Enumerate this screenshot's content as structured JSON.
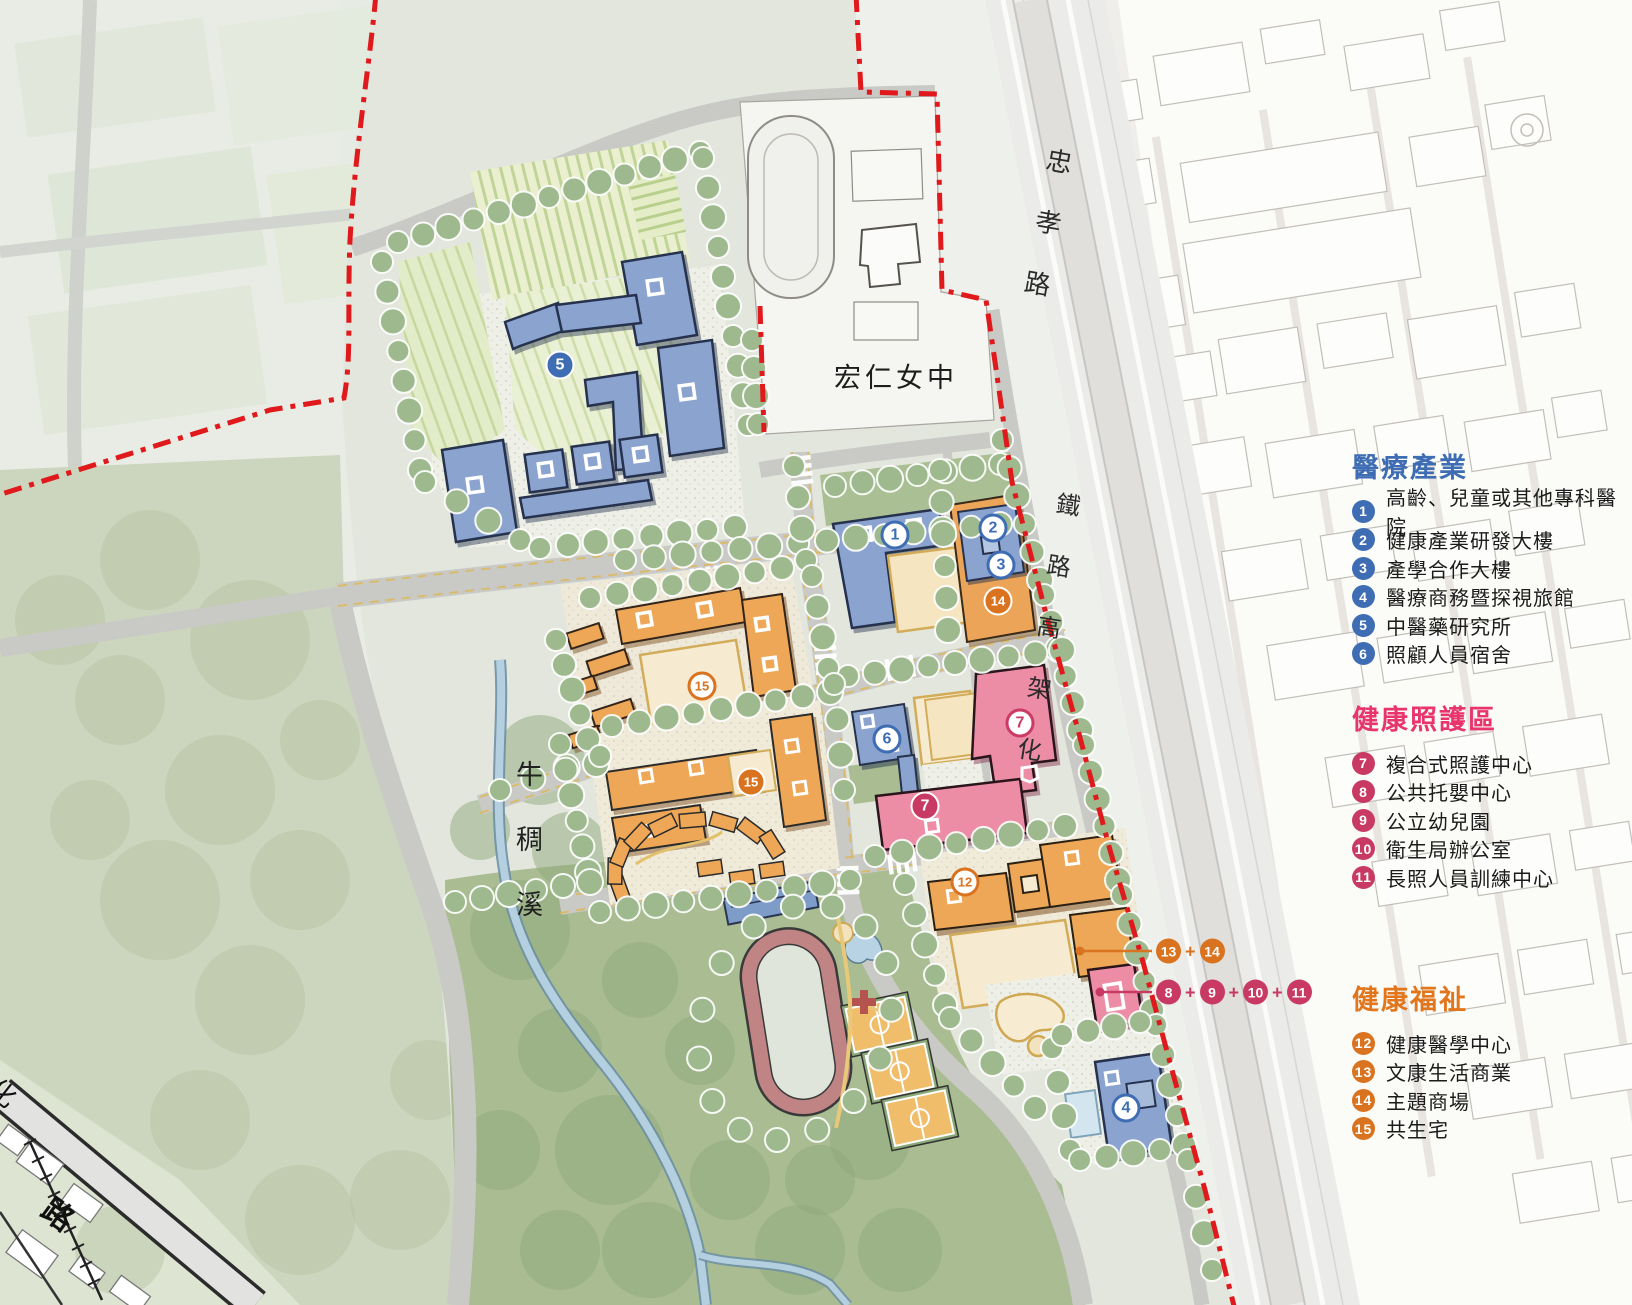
{
  "map_labels": {
    "school": "宏仁女中",
    "road_zhongxiao": "忠孝路",
    "railway_elevated": "鐵路高架化",
    "stream": "牛稠溪",
    "road_char_bottom_left": "路",
    "road_char_left_edge": "化"
  },
  "colors": {
    "medical_blue": "#3e6db4",
    "care_pink_header": "#e8356e",
    "care_pink_badge": "#c83a64",
    "welfare_orange_header": "#e2761c",
    "welfare_orange_badge": "#d9731f",
    "boundary_red": "#e0191c"
  },
  "legend_groups": [
    {
      "id": "medical",
      "title": "醫療產業",
      "header_color": "#3e6db4",
      "badge_color": "#3e6db4",
      "items": [
        {
          "num": "1",
          "label": "高齡、兒童或其他專科醫院"
        },
        {
          "num": "2",
          "label": "健康產業研發大樓"
        },
        {
          "num": "3",
          "label": "產學合作大樓"
        },
        {
          "num": "4",
          "label": "醫療商務暨探視旅館"
        },
        {
          "num": "5",
          "label": "中醫藥研究所"
        },
        {
          "num": "6",
          "label": "照顧人員宿舍"
        }
      ]
    },
    {
      "id": "care",
      "title": "健康照護區",
      "header_color": "#e8356e",
      "badge_color": "#c83a64",
      "items": [
        {
          "num": "7",
          "label": "複合式照護中心"
        },
        {
          "num": "8",
          "label": "公共托嬰中心"
        },
        {
          "num": "9",
          "label": "公立幼兒園"
        },
        {
          "num": "10",
          "label": "衛生局辦公室"
        },
        {
          "num": "11",
          "label": "長照人員訓練中心"
        }
      ]
    },
    {
      "id": "welfare",
      "title": "健康福祉",
      "header_color": "#e2761c",
      "badge_color": "#d9731f",
      "items": [
        {
          "num": "12",
          "label": "健康醫學中心"
        },
        {
          "num": "13",
          "label": "文康生活商業"
        },
        {
          "num": "14",
          "label": "主題商場"
        },
        {
          "num": "15",
          "label": "共生宅"
        }
      ]
    }
  ],
  "map_badges": [
    {
      "num": "5",
      "x": 560,
      "y": 365,
      "variant": "fill-blue"
    },
    {
      "num": "1",
      "x": 895,
      "y": 535,
      "variant": "outline-blue"
    },
    {
      "num": "2",
      "x": 993,
      "y": 528,
      "variant": "outline-blue"
    },
    {
      "num": "3",
      "x": 1001,
      "y": 565,
      "variant": "outline-blue"
    },
    {
      "num": "14",
      "x": 998,
      "y": 601,
      "variant": "fill-orange"
    },
    {
      "num": "15",
      "x": 702,
      "y": 686,
      "variant": "outline-orange"
    },
    {
      "num": "6",
      "x": 887,
      "y": 739,
      "variant": "outline-blue"
    },
    {
      "num": "7",
      "x": 1020,
      "y": 723,
      "variant": "outline-pink"
    },
    {
      "num": "15",
      "x": 751,
      "y": 782,
      "variant": "fill-orange"
    },
    {
      "num": "7",
      "x": 925,
      "y": 806,
      "variant": "fill-pink"
    },
    {
      "num": "12",
      "x": 965,
      "y": 882,
      "variant": "outline-orange"
    },
    {
      "num": "4",
      "x": 1126,
      "y": 1108,
      "variant": "outline-blue"
    }
  ],
  "callouts": [
    {
      "id": "welfare",
      "separator": "+",
      "color": "#d9731f",
      "items": [
        "13",
        "14"
      ]
    },
    {
      "id": "care",
      "separator": "+",
      "color": "#c83a64",
      "items": [
        "8",
        "9",
        "10",
        "11"
      ]
    }
  ]
}
